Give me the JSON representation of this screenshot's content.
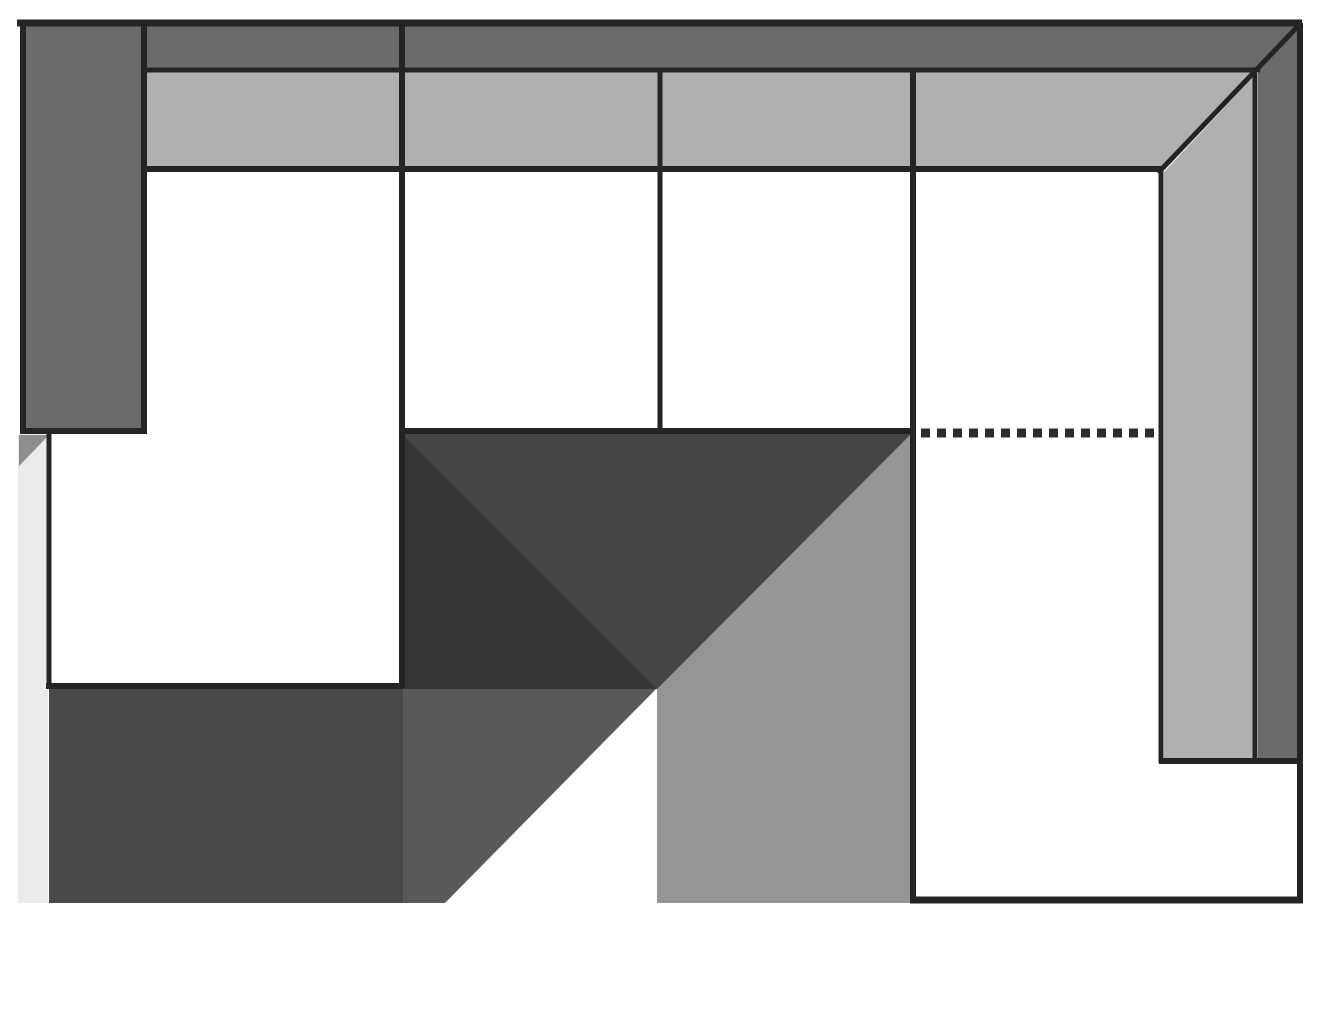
{
  "diagram": {
    "kind": "sectional-sofa-plan",
    "dotted_dash": "9 7"
  },
  "colors": {
    "background": "#ffffff",
    "outline": "#242424",
    "frame_gray": "#6b6b6b",
    "band_gray": "#b0b0b0",
    "chaise_dark": "#454545",
    "chaise_shadow": "#363636",
    "block_dark": "#494949",
    "block_medium": "#595959",
    "block_light": "#959595",
    "pale_strip": "#ebebeb",
    "strip_corner": "#8d8d8d",
    "dotted_line": "#2b2b2b"
  }
}
